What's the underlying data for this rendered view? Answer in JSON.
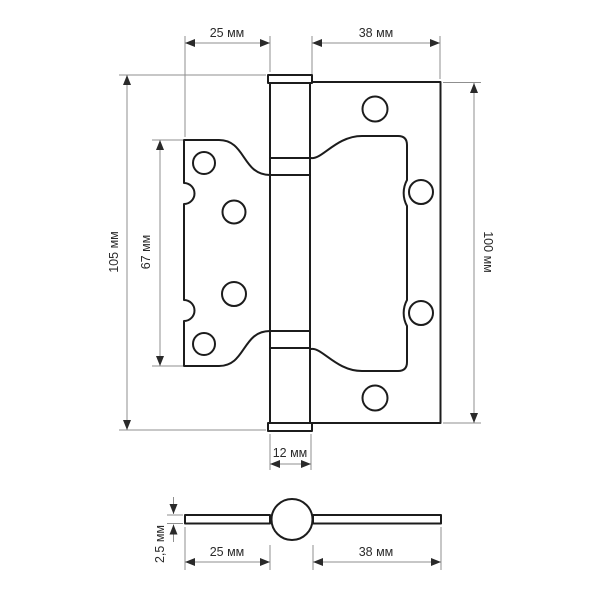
{
  "drawing": {
    "kind": "door-hinge-technical-drawing",
    "front_view": {
      "leaf_left_width": "25 мм",
      "leaf_right_width": "38 мм",
      "overall_height": "105 мм",
      "leaf_left_height": "67 мм",
      "leaf_right_height": "100 мм",
      "knuckle_width": "12 мм"
    },
    "side_view": {
      "plate_thickness": "2,5 мм",
      "leaf_left_width": "25 мм",
      "leaf_right_width": "38 мм"
    }
  },
  "colors": {
    "outline": "#1c1c1c",
    "dimension_lines": "#8f8f8f",
    "text": "#2b2b2b",
    "background": "#ffffff"
  }
}
